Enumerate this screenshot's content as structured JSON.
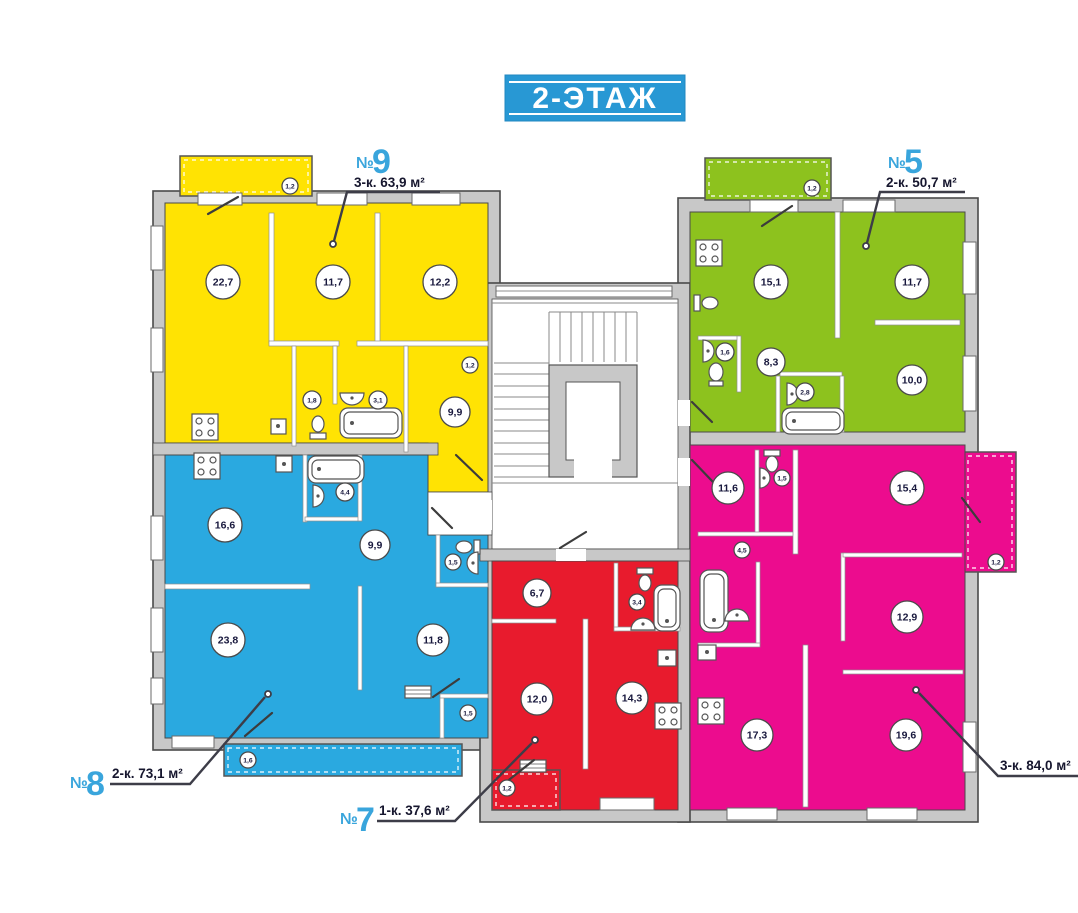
{
  "title": {
    "banner": "2-ЭТАЖ"
  },
  "palette": {
    "banner_blue": "#2898d4",
    "apt9_yellow": "#ffe303",
    "apt5_green": "#8dc21e",
    "apt8_blue": "#2aa9e0",
    "apt7_red": "#e81b2d",
    "apt6_magenta": "#ec0c8e",
    "wall_gray": "#c8c8c8",
    "label_blue": "#39a5dc",
    "label_dark": "#16162e"
  },
  "apartments": {
    "apt9": {
      "no": "№",
      "num": "9",
      "spec": "3-к. 63,9 м²",
      "rooms": {
        "r1": "22,7",
        "r2": "11,7",
        "r3": "12,2",
        "r4": "9,9",
        "wc": "1,8",
        "bath": "3,1",
        "hall": "1,2",
        "balcony": "1,2"
      }
    },
    "apt5": {
      "no": "№",
      "num": "5",
      "spec": "2-к. 50,7 м²",
      "rooms": {
        "r1": "15,1",
        "r2": "11,7",
        "r3": "8,3",
        "r4": "10,0",
        "hall": "1,6",
        "bath": "2,8",
        "balcony": "1,2"
      }
    },
    "apt8": {
      "no": "№",
      "num": "8",
      "spec": "2-к. 73,1 м²",
      "rooms": {
        "r1": "16,6",
        "r2": "9,9",
        "r3": "23,8",
        "r4": "11,8",
        "bath": "4,4",
        "wc": "1,5",
        "closet": "1,5",
        "balcony": "1,6"
      }
    },
    "apt7": {
      "no": "№",
      "num": "7",
      "spec": "1-к. 37,6 м²",
      "rooms": {
        "r1": "6,7",
        "r2": "12,0",
        "r3": "14,3",
        "bath": "3,4",
        "balcony": "1,2"
      }
    },
    "apt6": {
      "spec": "3-к. 84,0 м²",
      "rooms": {
        "r1": "11,6",
        "r2": "15,4",
        "r3": "12,9",
        "r4": "17,3",
        "r5": "19,6",
        "wc": "1,5",
        "hall": "4,5",
        "balcony": "1,2"
      }
    }
  }
}
